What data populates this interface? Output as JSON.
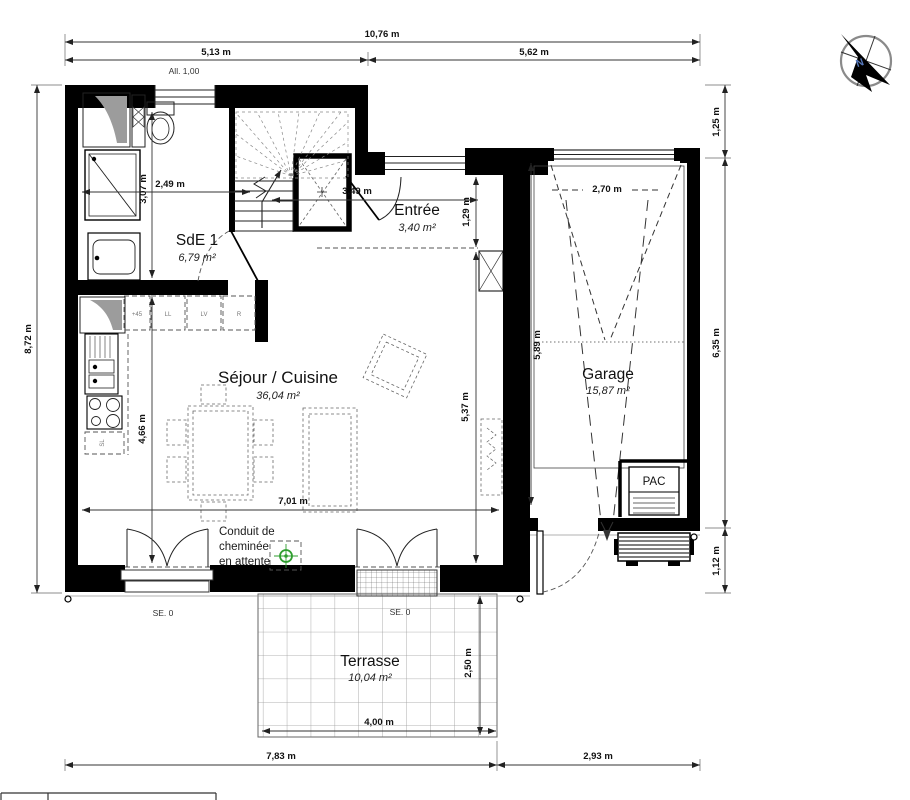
{
  "rooms": {
    "sde": {
      "name": "SdE 1",
      "area": "6,79 m²"
    },
    "entree": {
      "name": "Entrée",
      "area": "3,40 m²"
    },
    "sejour": {
      "name": "Séjour / Cuisine",
      "area": "36,04 m²"
    },
    "garage": {
      "name": "Garage",
      "area": "15,87 m²"
    },
    "terrasse": {
      "name": "Terrasse",
      "area": "10,04 m²"
    }
  },
  "dims": {
    "top_total": "10,76 m",
    "top_left": "5,13 m",
    "top_right": "5,62 m",
    "left_total": "8,72 m",
    "right_top": "1,25 m",
    "right_mid": "6,35 m",
    "right_bottom": "1,12 m",
    "bottom_left": "7,83 m",
    "bottom_right": "2,93 m",
    "sde_w": "2,49 m",
    "sde_h": "3,07 m",
    "entree_w": "3,49 m",
    "entree_d": "1,29 m",
    "kitchen_h": "4,66 m",
    "sejour_w": "7,01 m",
    "sejour_h": "5,37 m",
    "garage_door_w": "2,70 m",
    "garage_d": "5,89 m",
    "terrasse_w": "4,00 m",
    "terrasse_d": "2,50 m"
  },
  "labels": {
    "window_sill": "All. 1,00",
    "threshold_left": "SE. 0",
    "threshold_terrace": "SE. 0",
    "chimney_l1": "Conduit de",
    "chimney_l2": "cheminée",
    "chimney_l3": "en attente",
    "pac": "PAC",
    "north": "N"
  },
  "kitchen_units": {
    "u1": "+45",
    "u2": "LL",
    "u3": "LV",
    "u4": "R",
    "u5": "SL"
  },
  "colors": {
    "wall": "#000000",
    "chimney_green": "#2f9e2f",
    "terrace_grid": "#8a8a8a"
  }
}
